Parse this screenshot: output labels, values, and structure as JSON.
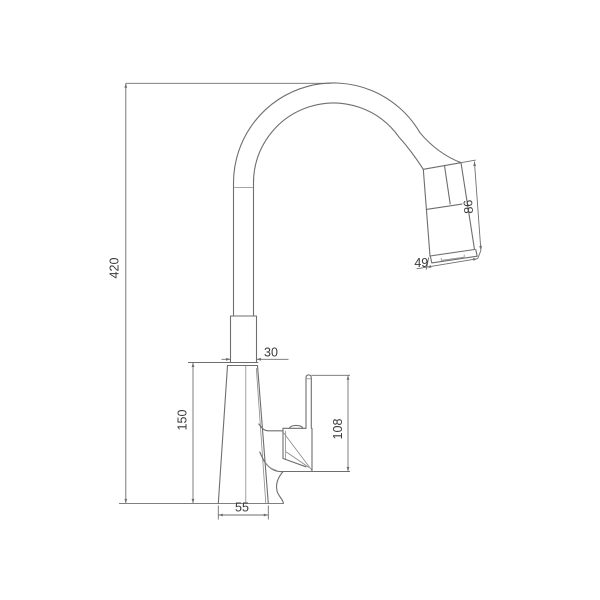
{
  "drawing": {
    "type": "technical-drawing",
    "subject": "pull-out kitchen faucet, side elevation with dimensions",
    "dimensions": {
      "overall_height": "420",
      "body_height": "150",
      "handle_height": "108",
      "base_width": "55",
      "neck_width": "30",
      "spray_tip_width": "49",
      "spray_head_length": "86"
    },
    "colors": {
      "line": "#6e6e6e",
      "text": "#3a3a3a",
      "background": "#ffffff"
    }
  }
}
